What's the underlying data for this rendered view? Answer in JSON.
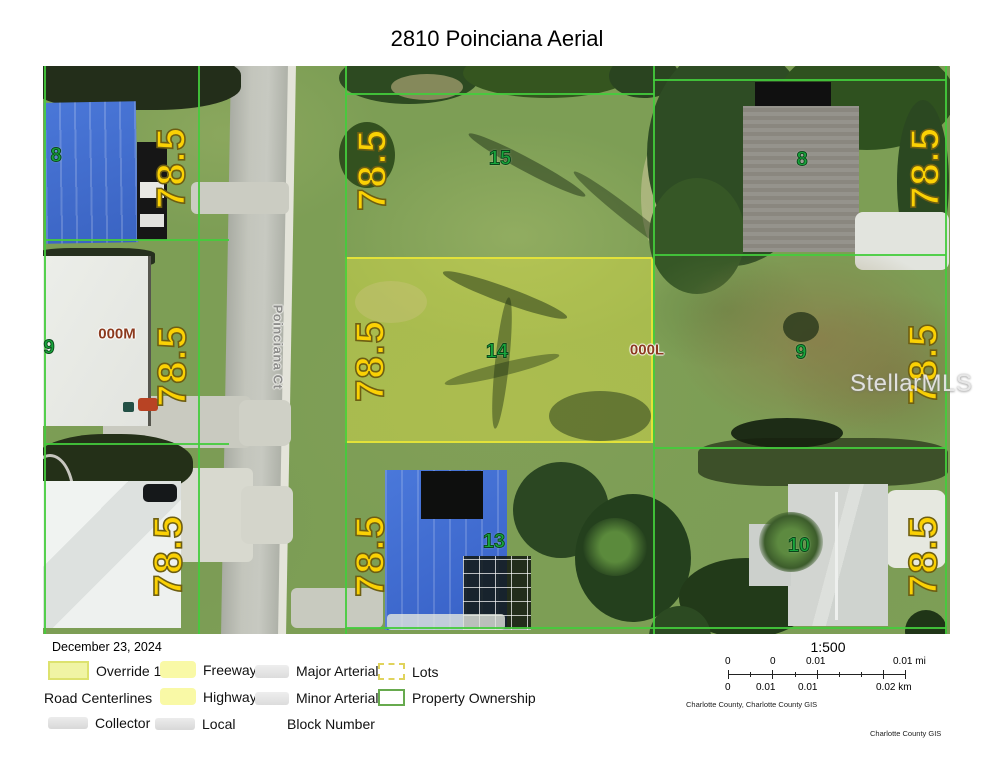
{
  "title": "2810 Poinciana Aerial",
  "map": {
    "street_label": "Poinciana Ct",
    "dimension_text": "78.5",
    "lot_numbers": {
      "nw": "8",
      "n": "15",
      "ne": "8",
      "w": "9",
      "c": "14",
      "e": "9",
      "s": "13",
      "se": "10"
    },
    "block_labels": {
      "west": "000M",
      "east": "000L"
    },
    "colors": {
      "dimension_text": "#fbd104",
      "lot_number": "#18a53c",
      "block_label": "#8c3a1e",
      "parcel_line": "#44cc3c",
      "lot_highlight_border": "#e2e23a"
    }
  },
  "watermark": "StellarMLS",
  "footer": {
    "date": "December 23, 2024",
    "legend": {
      "items": [
        {
          "label": "Override 1",
          "swatch": "override"
        },
        {
          "label": "Freeway",
          "swatch": "yellow-line"
        },
        {
          "label": "Major Arterial",
          "swatch": "gray-line"
        },
        {
          "label": "Lots",
          "swatch": "dashed-box"
        },
        {
          "label": "Road Centerlines",
          "swatch": "none"
        },
        {
          "label": "Highway",
          "swatch": "yellow-line"
        },
        {
          "label": "Minor Arterial",
          "swatch": "gray-line"
        },
        {
          "label": "Property Ownership",
          "swatch": "green-box"
        },
        {
          "label": "Collector",
          "swatch": "gray-line"
        },
        {
          "label": "Local",
          "swatch": "gray-line"
        },
        {
          "label": "Block Number",
          "swatch": "none"
        }
      ]
    },
    "scale": {
      "ratio": "1:500",
      "mi_labels": [
        "0",
        "0",
        "0.01",
        "0.01 mi"
      ],
      "km_labels": [
        "0",
        "0.01",
        "0.01",
        "0.02 km"
      ],
      "source_credit": "Charlotte County, Charlotte County GIS"
    },
    "bottom_credit": "Charlotte County GIS"
  }
}
